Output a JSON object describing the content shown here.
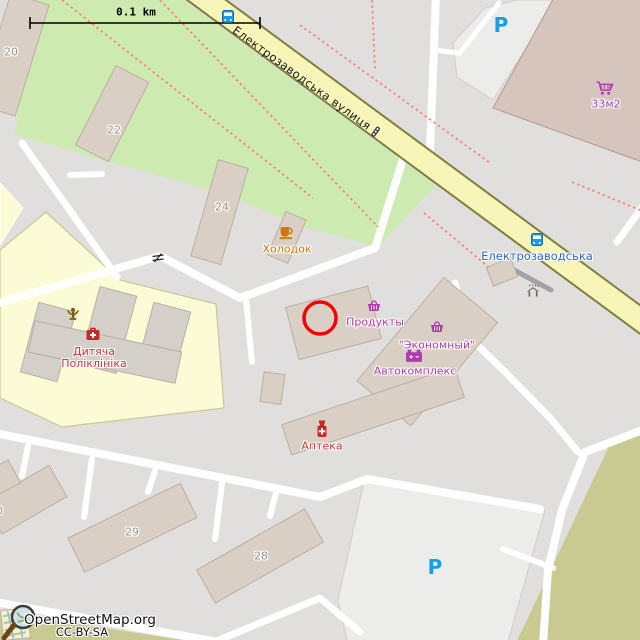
{
  "map": {
    "scale_bar": {
      "label": "0.1 km"
    },
    "street": {
      "name": "Електрозаводська вулиця"
    },
    "marker": {
      "x": 320,
      "y": 318,
      "radius": 16
    },
    "attribution": {
      "site": "OpenStreetMap.org",
      "license": "CC-BY-SA"
    }
  },
  "pois": {
    "bus_stop": {
      "label": "Електрозаводська",
      "icon": "bus-icon"
    },
    "holodok": {
      "label": "Холодок",
      "icon": "cafe-cup-icon"
    },
    "produkty": {
      "label": "Продукты",
      "icon": "shop-basket-icon"
    },
    "ekonomny": {
      "label": "\"Экономный\"",
      "icon": "shop-basket-icon"
    },
    "avtokompleks": {
      "label": "Автокомплекс",
      "icon": "car-battery-icon"
    },
    "apteka": {
      "label": "Аптека",
      "icon": "pharmacy-bottle-icon"
    },
    "polyclinic": {
      "line1": "Дитяча",
      "line2": "Поліклініка",
      "icon": "first-aid-kit-icon"
    },
    "shop_33m2": {
      "label": "33м2",
      "icon": "shopping-cart-icon"
    },
    "parking": {
      "symbol": "P"
    }
  },
  "building_numbers": {
    "n20": "20",
    "n22": "22",
    "n24": "24",
    "n28": "28",
    "n29": "29",
    "n30": "30"
  },
  "colors": {
    "background": "#e0dfdd",
    "grass": "#cdebb0",
    "hospital_grounds": "#fbfbd5",
    "street_fill": "#f7f6b8",
    "street_casing": "#7f7f3f",
    "road": "#ffffff",
    "building_fill": "#d9cfc5",
    "building_stroke": "#bcaf9f",
    "big_store_fill": "#d5c5bc",
    "parking_area": "#ececea",
    "olive_area": "#c9ca92",
    "footpath_dashed": "#f5897c",
    "shop_label": "#ae3cae",
    "amenity_label": "#cc3333",
    "cafe_label": "#c97800",
    "transit_label": "#2e66d0",
    "parking_blue": "#12a0e8",
    "marker_red": "#f00000"
  }
}
